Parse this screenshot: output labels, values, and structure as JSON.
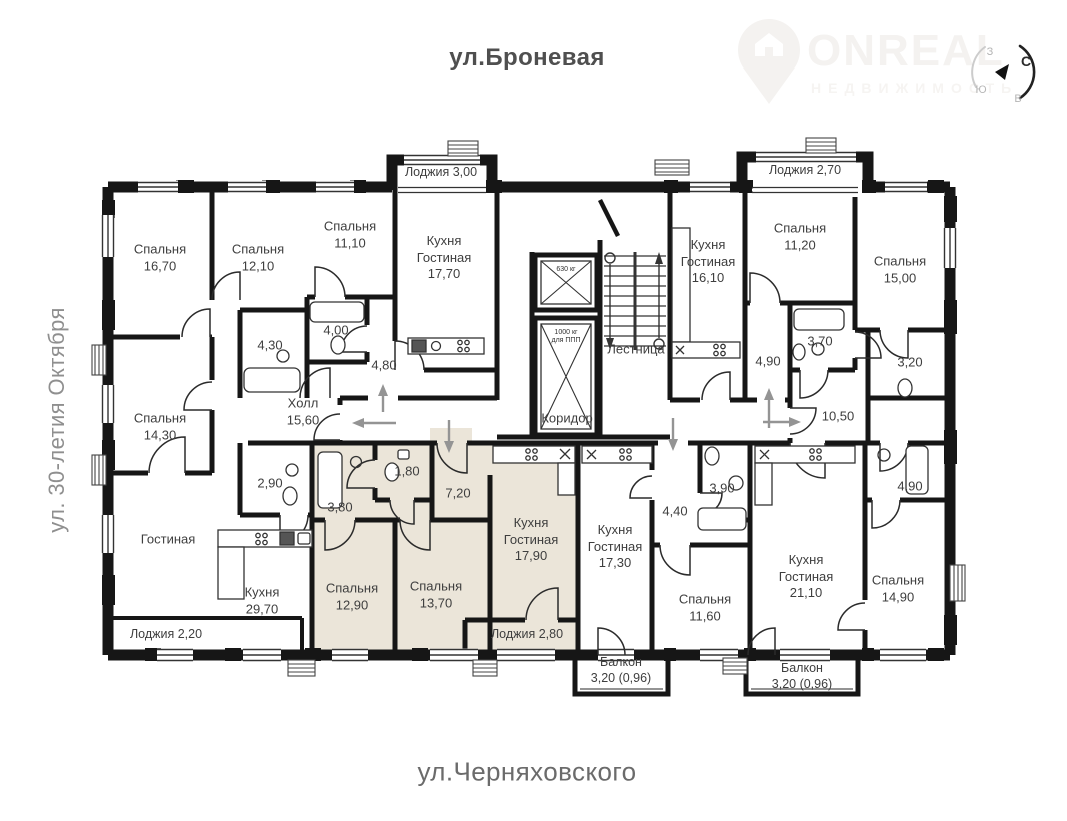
{
  "streets": {
    "top": "ул.Броневая",
    "bottom": "ул.Черняховского",
    "left": "ул. 30-летия Октября"
  },
  "logo": {
    "name": "ONREAL",
    "subtitle": "НЕДВИЖИМОСТЬ"
  },
  "compass": {
    "n": "С",
    "w": "З",
    "s": "Ю",
    "e": "В"
  },
  "elevators": {
    "small": "630 кг",
    "large_line1": "1000 кг",
    "large_line2": "для ППП"
  },
  "rooms": [
    {
      "name": "Спальня",
      "area": "16,70"
    },
    {
      "name": "Спальня",
      "area": "12,10"
    },
    {
      "name": "Спальня",
      "area": "11,10"
    },
    {
      "name": "Кухня\nГостиная",
      "area": "17,70"
    },
    {
      "name": "Лоджия 3,00",
      "area": ""
    },
    {
      "name": "Лестница",
      "area": ""
    },
    {
      "name": "Коридор",
      "area": ""
    },
    {
      "name": "Кухня\nГостиная",
      "area": "16,10"
    },
    {
      "name": "Спальня",
      "area": "11,20"
    },
    {
      "name": "Лоджия 2,70",
      "area": ""
    },
    {
      "name": "Спальня",
      "area": "15,00"
    },
    {
      "name": "",
      "area": "3,70"
    },
    {
      "name": "",
      "area": "3,20"
    },
    {
      "name": "",
      "area": "4,90"
    },
    {
      "name": "",
      "area": "10,50"
    },
    {
      "name": "",
      "area": "4,90"
    },
    {
      "name": "Спальня",
      "area": "14,90"
    },
    {
      "name": "Кухня\nГостиная",
      "area": "21,10"
    },
    {
      "name": "Балкон",
      "area": "3,20 (0,96)"
    },
    {
      "name": "Спальня",
      "area": "11,60"
    },
    {
      "name": "Балкон",
      "area": "3,20 (0,96)"
    },
    {
      "name": "Кухня\nГостиная",
      "area": "17,30"
    },
    {
      "name": "",
      "area": "4,40"
    },
    {
      "name": "",
      "area": "3,90"
    },
    {
      "name": "Кухня\nГостиная",
      "area": "17,90"
    },
    {
      "name": "Лоджия 2,80",
      "area": ""
    },
    {
      "name": "Спальня",
      "area": "13,70"
    },
    {
      "name": "Спальня",
      "area": "12,90"
    },
    {
      "name": "",
      "area": "7,20"
    },
    {
      "name": "",
      "area": "1,80"
    },
    {
      "name": "",
      "area": "3,80"
    },
    {
      "name": "",
      "area": "2,90"
    },
    {
      "name": "Холл",
      "area": "15,60"
    },
    {
      "name": "Гостиная",
      "area": ""
    },
    {
      "name": "Кухня",
      "area": "29,70"
    },
    {
      "name": "Лоджия 2,20",
      "area": ""
    },
    {
      "name": "Спальня",
      "area": "14,30"
    },
    {
      "name": "",
      "area": "4,30"
    },
    {
      "name": "",
      "area": "4,00"
    },
    {
      "name": "",
      "area": "4,80"
    }
  ]
}
